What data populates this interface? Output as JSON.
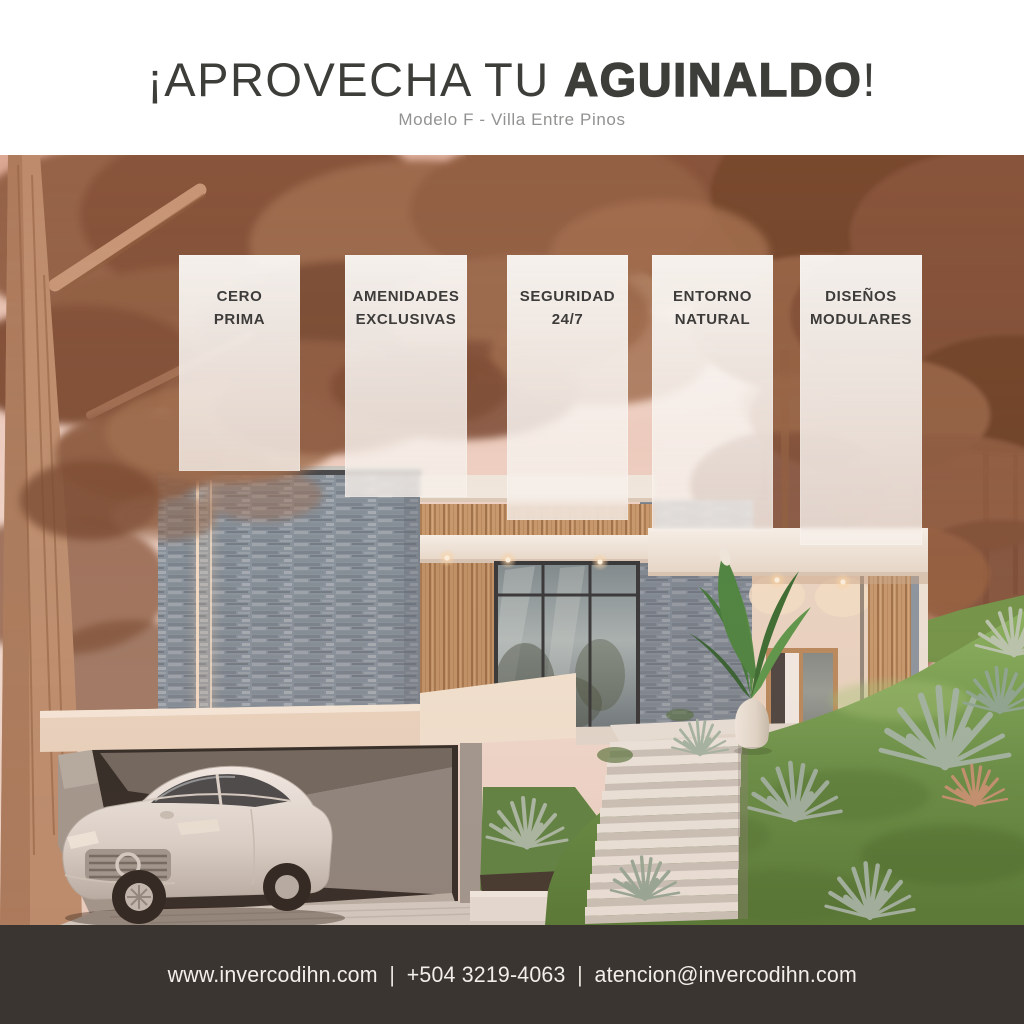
{
  "header": {
    "title_prefix": "¡APROVECHA TU ",
    "title_emphasis": "AGUINALDO",
    "title_suffix": "!",
    "subtitle": "Modelo F - Villa Entre Pinos"
  },
  "feature_cards": [
    {
      "line1": "CERO",
      "line2": "PRIMA"
    },
    {
      "line1": "AMENIDADES",
      "line2": "EXCLUSIVAS"
    },
    {
      "line1": "SEGURIDAD",
      "line2": "24/7"
    },
    {
      "line1": "ENTORNO",
      "line2": "NATURAL"
    },
    {
      "line1": "DISEÑOS",
      "line2": "MODULARES"
    }
  ],
  "footer": {
    "website": "www.invercodihn.com",
    "separator": "|",
    "phone": "+504 3219-4063",
    "email": "atencion@invercodihn.com"
  },
  "photo": {
    "alt": "Modern villa with stone and wood facade among sepia-toned pine trees, white sedan parked in open garage, concrete stairs and sloped lawn with agave plants"
  },
  "colors": {
    "footer_bg": "#3A3531",
    "title_text": "#3D3E3A",
    "subtitle_text": "#929290",
    "card_bg": "#F7F2EE",
    "card_text": "#3D3C3A",
    "sky_tint": "#EFCDBF"
  }
}
